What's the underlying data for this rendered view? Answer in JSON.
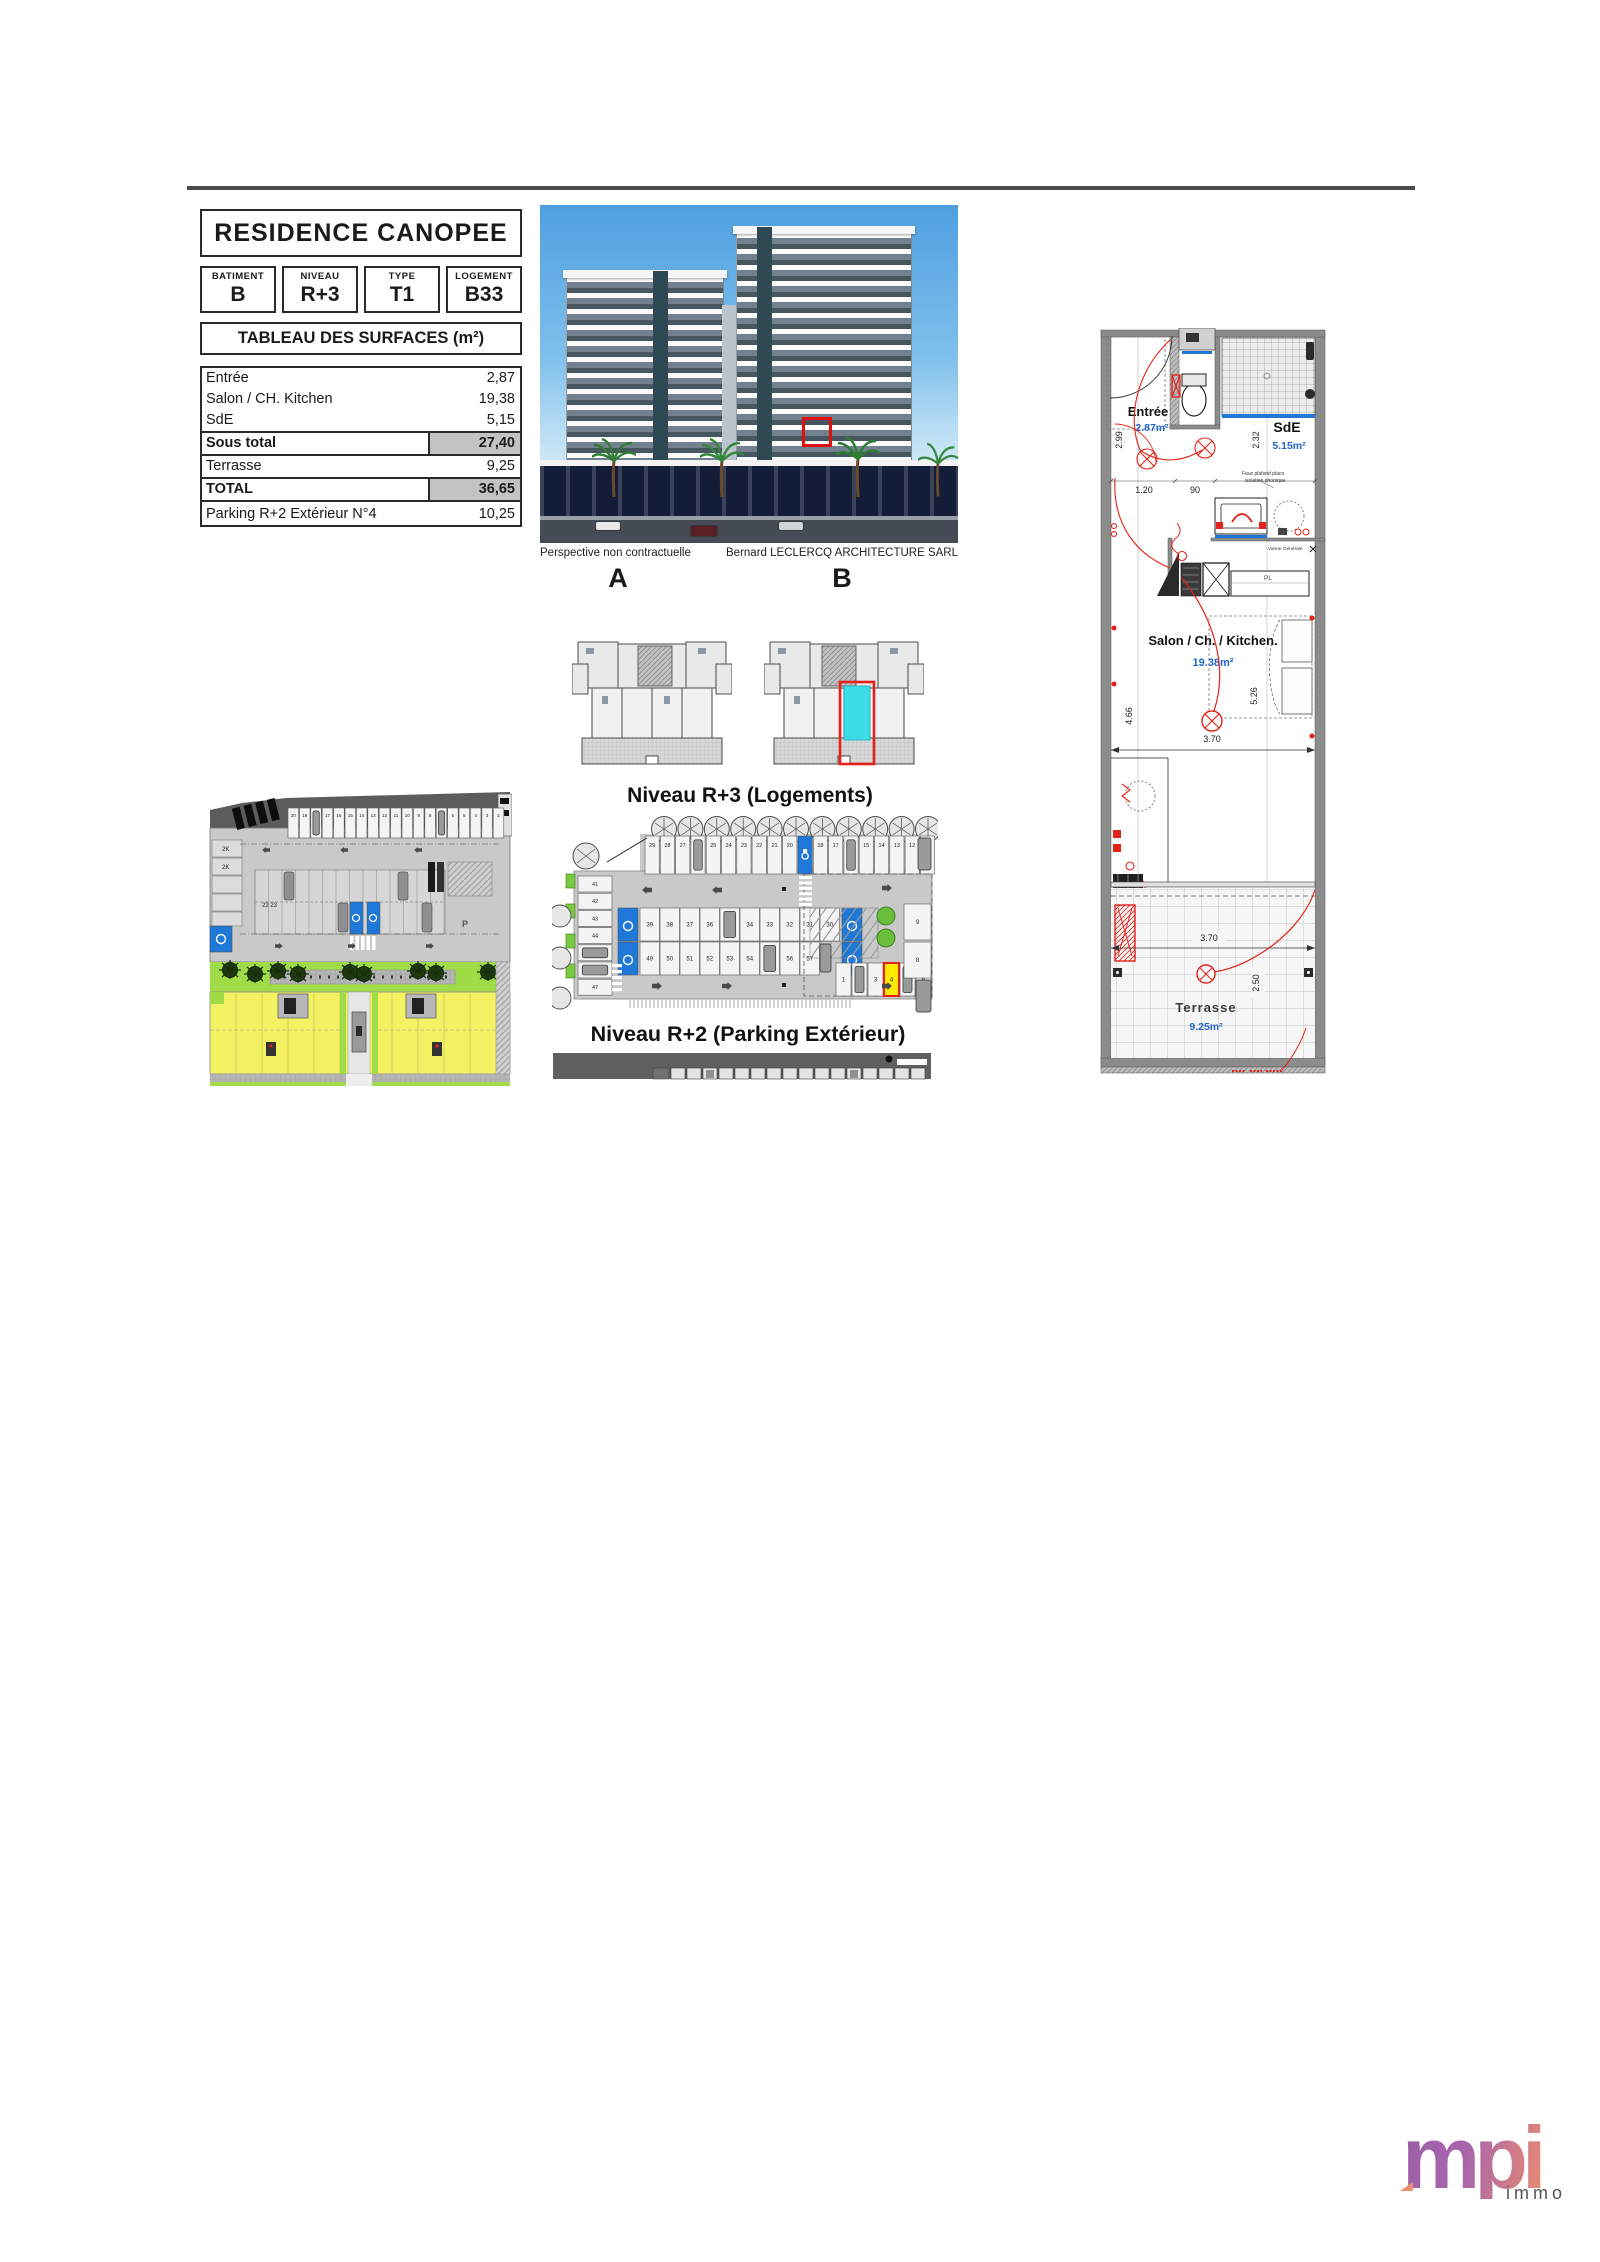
{
  "document": {
    "title": "RESIDENCE CANOPEE",
    "fields": {
      "batiment_label": "BATIMENT",
      "batiment_value": "B",
      "niveau_label": "NIVEAU",
      "niveau_value": "R+3",
      "type_label": "TYPE",
      "type_value": "T1",
      "logement_label": "LOGEMENT",
      "logement_value": "B33"
    },
    "surfaces": {
      "header": "TABLEAU DES SURFACES (m²)",
      "rows": [
        {
          "label": "Entrée",
          "value": "2,87"
        },
        {
          "label": "Salon / CH. Kitchen",
          "value": "19,38"
        },
        {
          "label": "SdE",
          "value": "5,15"
        },
        {
          "label": "Sous total",
          "value": "27,40"
        },
        {
          "label": "Terrasse",
          "value": "9,25"
        },
        {
          "label": "TOTAL",
          "value": "36,65"
        },
        {
          "label": "Parking R+2  Extérieur  N°4",
          "value": "10,25"
        }
      ]
    }
  },
  "perspective": {
    "caption_left": "Perspective non contractuelle",
    "caption_right": "Bernard LECLERCQ ARCHITECTURE SARL"
  },
  "sections": {
    "label_a": "A",
    "label_b": "B",
    "niveau_r3": "Niveau R+3 (Logements)",
    "niveau_r2": "Niveau R+2 (Parking Extérieur)"
  },
  "parking_r2": {
    "top_row": [
      "29",
      "28",
      "27",
      "26",
      "25",
      "24",
      "23",
      "22",
      "21",
      "20",
      "19",
      "18",
      "17",
      "16",
      "15",
      "14",
      "13",
      "12",
      "11"
    ],
    "left_col": [
      "41",
      "42",
      "43",
      "44",
      "45",
      "46",
      "47"
    ],
    "mid_row1": [
      "39",
      "38",
      "37",
      "36",
      "35",
      "34",
      "33",
      "32",
      "31",
      "30"
    ],
    "mid_row2": [
      "49",
      "50",
      "51",
      "52",
      "53",
      "54",
      "55",
      "56",
      "57"
    ],
    "right_row": [
      "1",
      "2",
      "3",
      "4",
      "5",
      "6"
    ],
    "right_col": [
      "9",
      "8"
    ],
    "highlighted_space": "4"
  },
  "site_plan": {
    "top_row": [
      "20",
      "19",
      "18",
      "17",
      "16",
      "15",
      "14",
      "13",
      "12",
      "11",
      "10",
      "9",
      "8",
      "7",
      "6",
      "5",
      "4",
      "3",
      "2"
    ],
    "left_labels": [
      "2K",
      "2K"
    ],
    "mid_label": "22 23",
    "p_label": "P"
  },
  "apartment": {
    "entree": {
      "name": "Entrée",
      "area": "2.87m²"
    },
    "sde": {
      "name": "SdE",
      "area": "5.15m²"
    },
    "salon": {
      "name": "Salon / Ch. / Kitchen.",
      "area": "19.38m²"
    },
    "terrasse": {
      "name": "Terrasse",
      "area": "9.25m²"
    },
    "dims": {
      "entree_h": "2.99",
      "sde_h": "2.32",
      "entree_w": "1.20",
      "wc_w": "90",
      "salon_h": "4.66",
      "salon_h2": "5.26",
      "salon_w": "3.70",
      "terr_w": "3.70",
      "terr_h": "2.50"
    },
    "annotations": {
      "ceiling1": "Faux plafond placo",
      "ceiling2": "isolation phonique",
      "valve": "Vanne Générale",
      "counter": "PL"
    }
  },
  "logo": {
    "main": "mpi",
    "sub": "immo"
  },
  "colors": {
    "handicap_blue": "#1e78d8",
    "unit_cyan": "#3ddde8",
    "highlight_red": "#e32219",
    "parking_yellow": "#ffe900",
    "area_text_blue": "#1f66cc",
    "site_yellow": "#f4f163",
    "site_green": "#9fdc48",
    "logo_purple": "#9a5fa7",
    "logo_orange": "#ee8e6d"
  }
}
